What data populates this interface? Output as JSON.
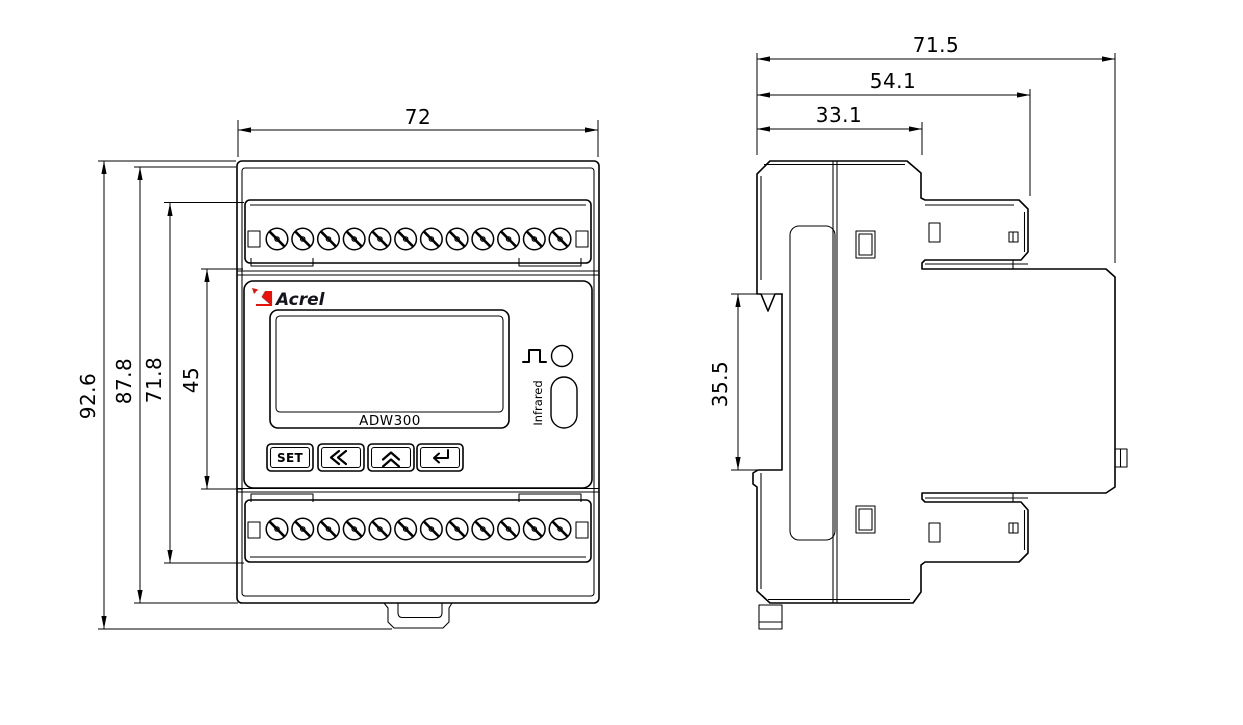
{
  "front_view": {
    "brand": "Acrel",
    "model": "ADW300",
    "infrared_label": "Infrared",
    "terminals_per_row": 12,
    "buttons": {
      "set_label": "SET",
      "icons": [
        "double-left-chevron-icon",
        "double-up-chevron-icon",
        "enter-arrow-icon"
      ]
    },
    "indicators": [
      "pulse-icon",
      "pulse-led",
      "infrared-window"
    ],
    "dimensions": {
      "width": "72",
      "overall_height": "92.6",
      "body_height": "87.8",
      "terminal_span": "71.8",
      "panel_height": "45"
    }
  },
  "side_view": {
    "dimensions": {
      "overall_depth": "71.5",
      "terminal_depth": "54.1",
      "body_depth": "33.1",
      "rail_span": "35.5"
    }
  },
  "colors": {
    "line": "#000000",
    "logo_red": "#e8120c",
    "brand_text": "#14141c",
    "background": "#ffffff"
  }
}
